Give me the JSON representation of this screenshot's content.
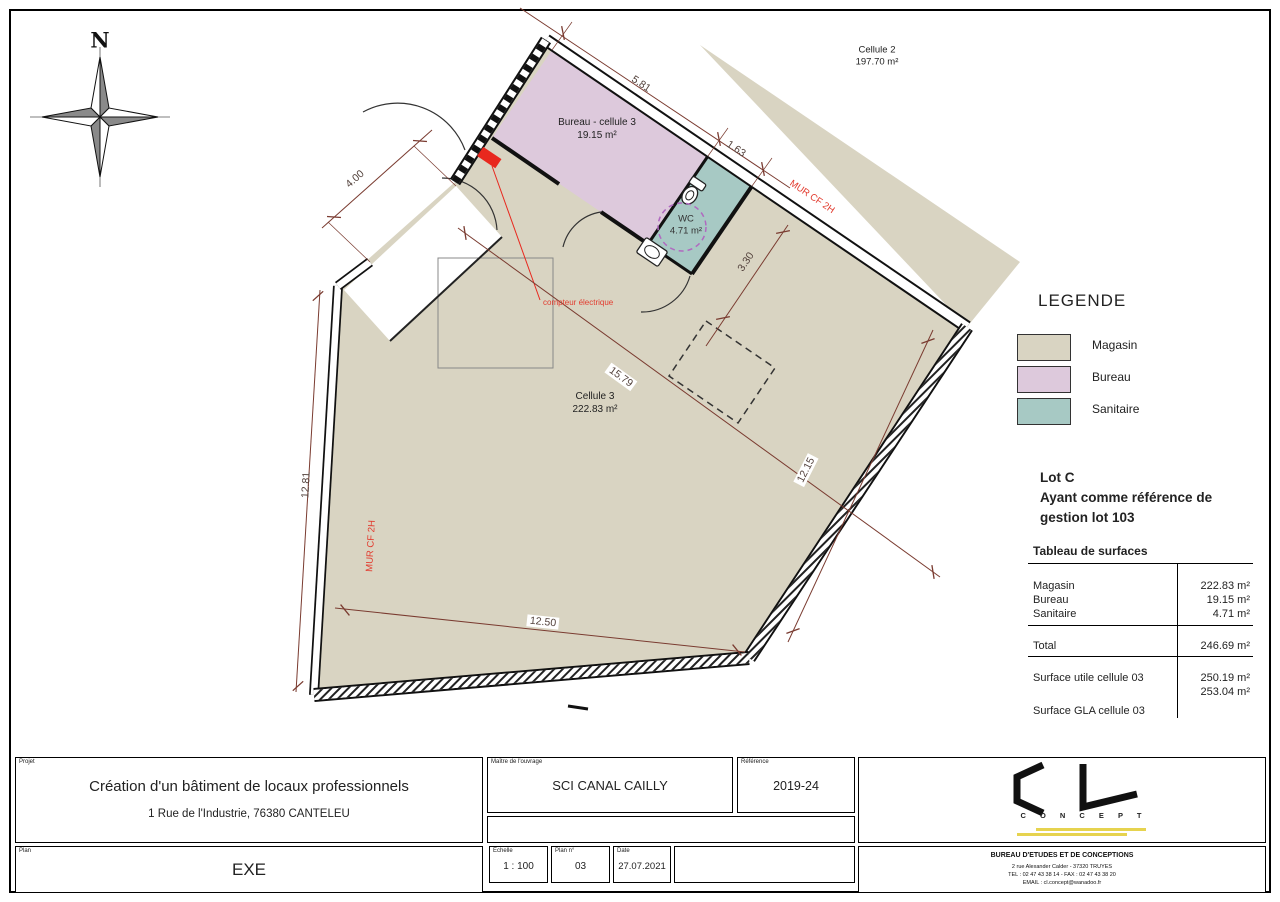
{
  "sheet": {
    "compass_north": "N"
  },
  "plan": {
    "rooms": {
      "cellule2": {
        "name": "Cellule 2",
        "area": "197.70 m²"
      },
      "bureau": {
        "name": "Bureau - cellule 3",
        "area": "19.15 m²"
      },
      "wc": {
        "name": "WC",
        "area": "4.71 m²"
      },
      "cellule3": {
        "name": "Cellule 3",
        "area": "222.83 m²"
      }
    },
    "dimensions": {
      "d581": "5.81",
      "d163": "1.63",
      "d400": "4.00",
      "d330": "3.30",
      "d1579": "15.79",
      "d1281": "12.81",
      "d1215": "12.15",
      "d1250": "12.50"
    },
    "annotations": {
      "fire_wall_top": "MUR CF 2H",
      "fire_wall_left": "MUR CF 2H",
      "electric_meter": "compteur électrique"
    }
  },
  "legend": {
    "title": "LEGENDE",
    "items": [
      {
        "label": "Magasin",
        "color": "#d9d4c2"
      },
      {
        "label": "Bureau",
        "color": "#ddc9dc"
      },
      {
        "label": "Sanitaire",
        "color": "#a7c9c4"
      }
    ]
  },
  "lot": {
    "line1": "Lot C",
    "line2": "Ayant comme référence de",
    "line3": "gestion lot 103"
  },
  "surface_table": {
    "title": "Tableau de surfaces",
    "rows": [
      {
        "label": "Magasin",
        "value": "222.83 m²"
      },
      {
        "label": "Bureau",
        "value": "19.15 m²"
      },
      {
        "label": "Sanitaire",
        "value": "4.71 m²"
      }
    ],
    "total": {
      "label": "Total",
      "value": "246.69 m²"
    },
    "extra": [
      {
        "label": "Surface utile cellule 03",
        "value": "250.19 m²"
      },
      {
        "label": "Surface GLA cellule 03",
        "value": "253.04 m²"
      }
    ]
  },
  "title_block": {
    "project_label": "Projet",
    "project_title": "Création d'un bâtiment de locaux professionnels",
    "project_address": "1 Rue de l'Industrie, 76380 CANTELEU",
    "plan_label": "Plan",
    "plan_value": "EXE",
    "client_label": "Maître de l'ouvrage",
    "client_value": "SCI CANAL CAILLY",
    "reference_label": "Référence",
    "reference_value": "2019-24",
    "scale_label": "Echelle",
    "scale_value": "1 : 100",
    "plan_no_label": "Plan n°",
    "plan_no_value": "03",
    "date_label": "Date",
    "date_value": "27.07.2021",
    "logo_text": "C O N C E P T",
    "office": {
      "name": "BUREAU D'ETUDES ET DE CONCEPTIONS",
      "address": "2 rue Alexander Calder - 37320 TRUYES",
      "phone": "TEL : 02 47 43 38 14 - FAX : 02 47 43 38 20",
      "email": "EMAIL : cl.concept@wanadoo.fr"
    }
  }
}
